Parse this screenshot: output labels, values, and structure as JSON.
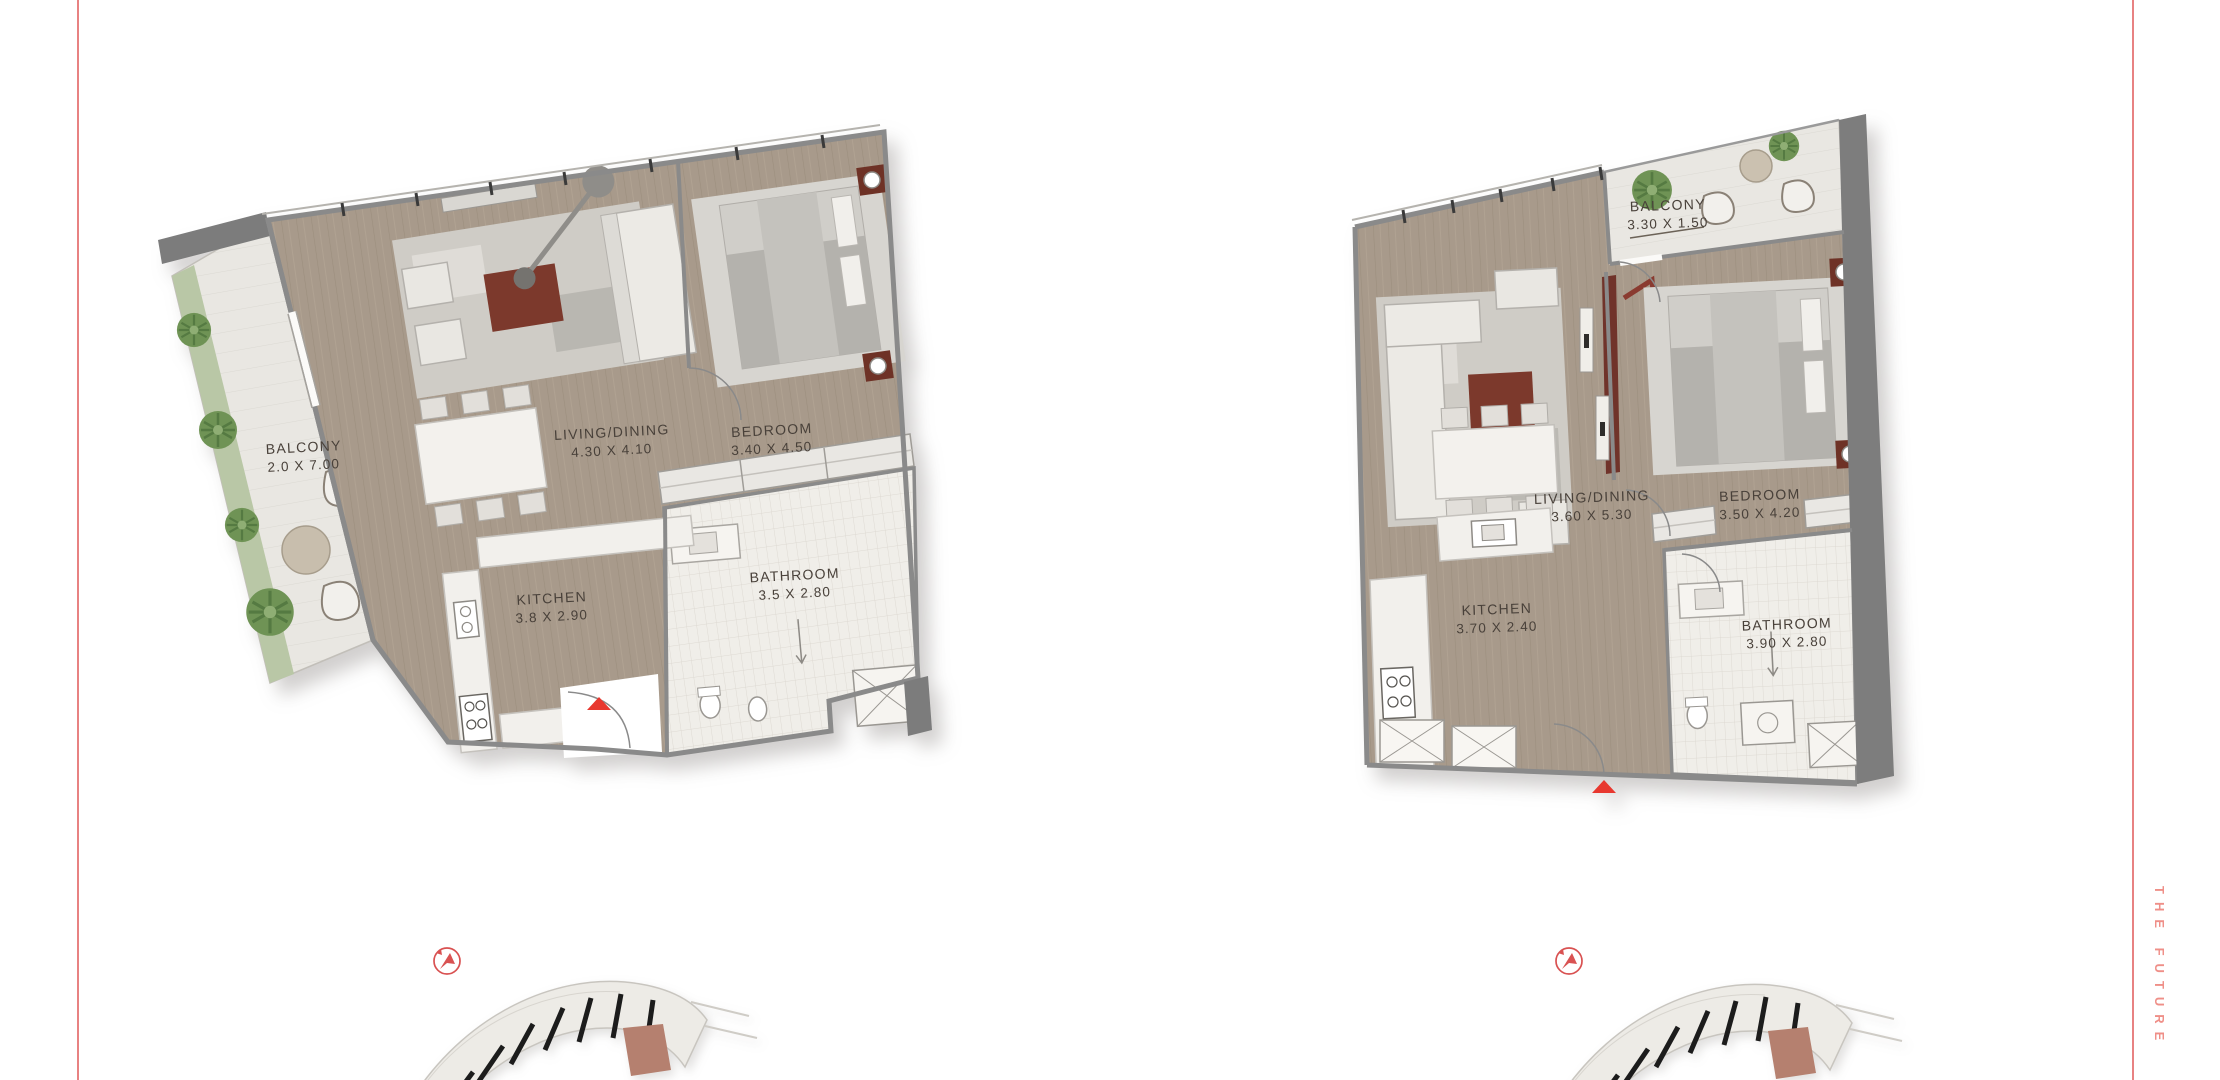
{
  "page": {
    "background_color": "#ffffff",
    "side_text": "THE FUTURE",
    "side_text_color": "#ef8f88",
    "border_rule_color": "#e88282",
    "entry_marker_color": "#e8382f",
    "compass_color": "#d95252",
    "keyplan_highlight_color": "#b5806f"
  },
  "icons": {
    "compass": "north-arrow-in-circle",
    "entry_marker": "red-up-triangle",
    "key_plan": "curved-floorplate-with-highlighted-unit"
  },
  "plans": [
    {
      "id": "left-unit",
      "rooms": [
        {
          "name": "BALCONY",
          "dims": "2.0 X 7.00"
        },
        {
          "name": "LIVING/DINING",
          "dims": "4.30 X 4.10"
        },
        {
          "name": "BEDROOM",
          "dims": "3.40 X 4.50"
        },
        {
          "name": "KITCHEN",
          "dims": "3.8 X 2.90"
        },
        {
          "name": "BATHROOM",
          "dims": "3.5 X 2.80"
        }
      ]
    },
    {
      "id": "right-unit",
      "rooms": [
        {
          "name": "BALCONY",
          "dims": "3.30 X 1.50"
        },
        {
          "name": "LIVING/DINING",
          "dims": "3.60 X 5.30"
        },
        {
          "name": "BEDROOM",
          "dims": "3.50 X 4.20"
        },
        {
          "name": "KITCHEN",
          "dims": "3.70 X 2.40"
        },
        {
          "name": "BATHROOM",
          "dims": "3.90 X 2.80"
        }
      ]
    }
  ]
}
